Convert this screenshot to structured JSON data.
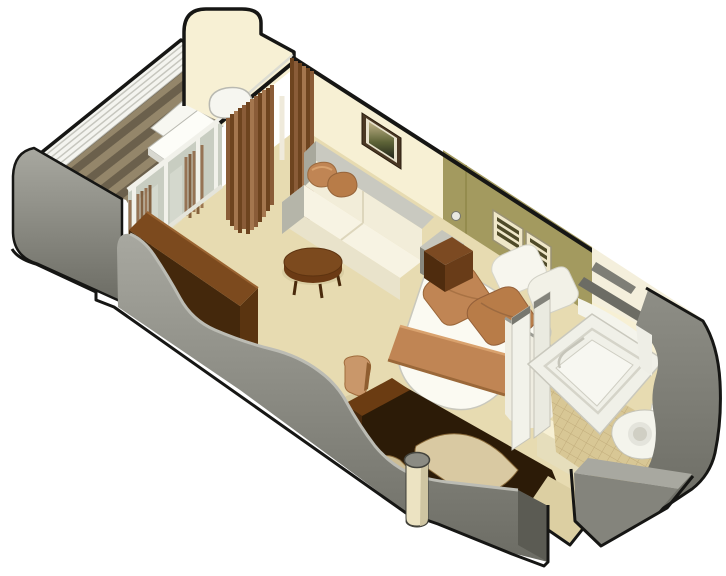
{
  "meta": {
    "title": "Isometric cutaway rendering of a ship stateroom floor plan with private balcony",
    "render_style": "3D axonometric cutaway, white background, black outlined walls"
  },
  "colors": {
    "page_bg": "#ffffff",
    "outline": "#161614",
    "wall_gray_light": "#a8a8a0",
    "wall_gray": "#8e8e86",
    "wall_gray_dark": "#6c6c64",
    "wall_gray_deep": "#5b5b53",
    "wall_cream": "#f7f0d4",
    "wall_cream_shade": "#e6debc",
    "bath_wall_cream": "#f4efdc",
    "olive": "#a39a5f",
    "olive_dark": "#8f8748",
    "olive_slat": "#4f4a28",
    "carpet": "#e7dbb1",
    "deck_dark": "#6b604c",
    "deck_light": "#94866a",
    "glass": "#c8cdc1",
    "glass_frame": "#f1f1ea",
    "glass_streak": "#dfe3d9",
    "curtain_dark": "#6e441f",
    "curtain_mid": "#8a5c38",
    "curtain_light": "#a4764e",
    "copper": "#c08554",
    "copper_dark": "#9b6839",
    "copper_light": "#d9a26e",
    "wood": "#7c4a1e",
    "wood_dark": "#44280c",
    "wood_deepest": "#2c1b07",
    "door_tan": "#d9c9a2",
    "cream_column": "#ece3c2",
    "tile": "#d8c795",
    "tile_line": "#c1ac7b",
    "fixture": "#f3f3ec",
    "fixture_shade": "#d7d6cb",
    "bedding": "#fbfaf2",
    "sofa_cream": "#f2edd9",
    "sofa_frame": "#9a9a8e",
    "railing_white": "#f4f4ef",
    "shadow_tan": "#d9cda2"
  },
  "scene": {
    "areas": [
      {
        "id": "balcony",
        "items": [
          "wood-deck",
          "railing-wall",
          "lounge-chair",
          "side-table",
          "sliding-glass-door",
          "end-wall"
        ]
      },
      {
        "id": "living-room",
        "items": [
          "curtains",
          "sofa",
          "throw-pillows",
          "coffee-table",
          "wall-art",
          "sideboard",
          "desk-chair",
          "carpet-floor"
        ]
      },
      {
        "id": "bedroom",
        "items": [
          "double-bed",
          "bed-runner",
          "bed-pillows",
          "nightstand",
          "headboard-panel",
          "vent-shelves",
          "reading-light",
          "wardrobe",
          "support-column"
        ]
      },
      {
        "id": "bathroom",
        "items": [
          "bathtub",
          "toilet",
          "tiled-floor",
          "partition-walls"
        ]
      },
      {
        "id": "entrance",
        "items": [
          "corridor-floor",
          "corridor-walls",
          "doorway"
        ]
      }
    ]
  }
}
